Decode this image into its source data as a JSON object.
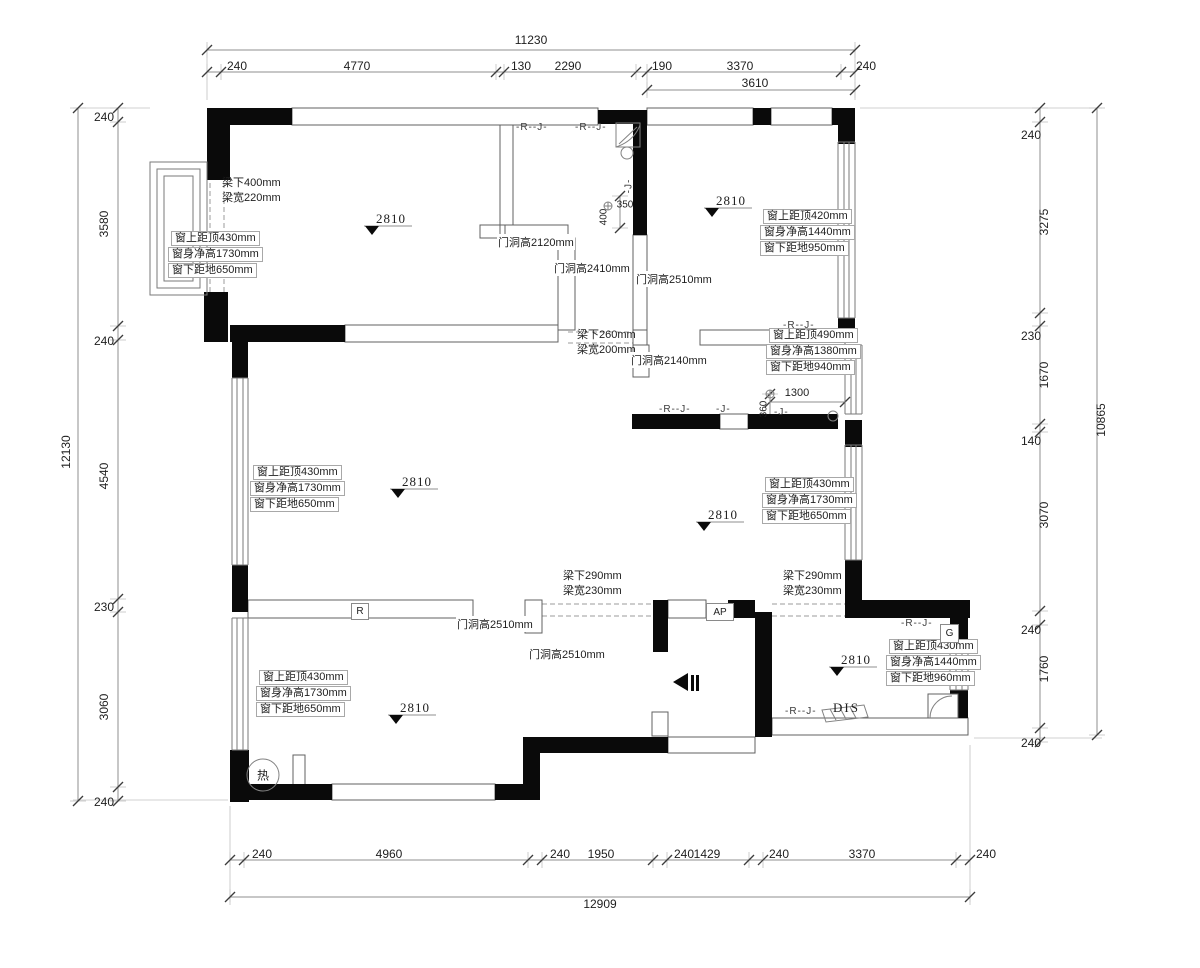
{
  "meta": {
    "type": "residential floor plan",
    "units": "mm"
  },
  "dims": {
    "top": {
      "overall": "11230",
      "sub": "3610",
      "segments": [
        "240",
        "4770",
        "130",
        "2290",
        "190",
        "3370",
        "240"
      ]
    },
    "bottom": {
      "overall": "12909",
      "segments": [
        "240",
        "4960",
        "240",
        "1950",
        "240",
        "1429",
        "240",
        "3370",
        "240"
      ]
    },
    "left": {
      "overall": "12130",
      "segments": [
        "240",
        "3580",
        "240",
        "4540",
        "230",
        "3060",
        "240"
      ]
    },
    "right": {
      "overall": "10865",
      "segments": [
        "240",
        "3275",
        "230",
        "1670",
        "140",
        "3070",
        "240",
        "1760",
        "240"
      ]
    },
    "inner": {
      "d1300": "1300",
      "d360": "360",
      "d350": "350",
      "d400": "400"
    }
  },
  "windows": [
    {
      "top": "窗上距顶430mm",
      "height": "窗身净高1730mm",
      "sill": "窗下距地650mm"
    },
    {
      "top": "窗上距顶420mm",
      "height": "窗身净高1440mm",
      "sill": "窗下距地950mm"
    },
    {
      "top": "窗上距顶490mm",
      "height": "窗身净高1380mm",
      "sill": "窗下距地940mm"
    },
    {
      "top": "窗上距顶430mm",
      "height": "窗身净高1730mm",
      "sill": "窗下距地650mm"
    },
    {
      "top": "窗上距顶430mm",
      "height": "窗身净高1730mm",
      "sill": "窗下距地650mm"
    },
    {
      "top": "窗上距顶430mm",
      "height": "窗身净高1730mm",
      "sill": "窗下距地650mm"
    },
    {
      "top": "窗上距顶430mm",
      "height": "窗身净高1440mm",
      "sill": "窗下距地960mm"
    }
  ],
  "beams": [
    {
      "under": "梁下400mm",
      "width": "梁宽220mm"
    },
    {
      "under": "梁下260mm",
      "width": "梁宽200mm"
    },
    {
      "under": "梁下290mm",
      "width": "梁宽230mm"
    },
    {
      "under": "梁下290mm",
      "width": "梁宽230mm"
    }
  ],
  "door_heights": [
    "门洞高2120mm",
    "门洞高2410mm",
    "门洞高2510mm",
    "门洞高2140mm",
    "门洞高2510mm",
    "门洞高2510mm"
  ],
  "elevation": {
    "value": "2810"
  },
  "tags": {
    "r": "R",
    "ap": "AP",
    "g": "G",
    "dis": "DIS",
    "heater": "热",
    "rj": "-R--J-",
    "j": "-J-"
  }
}
